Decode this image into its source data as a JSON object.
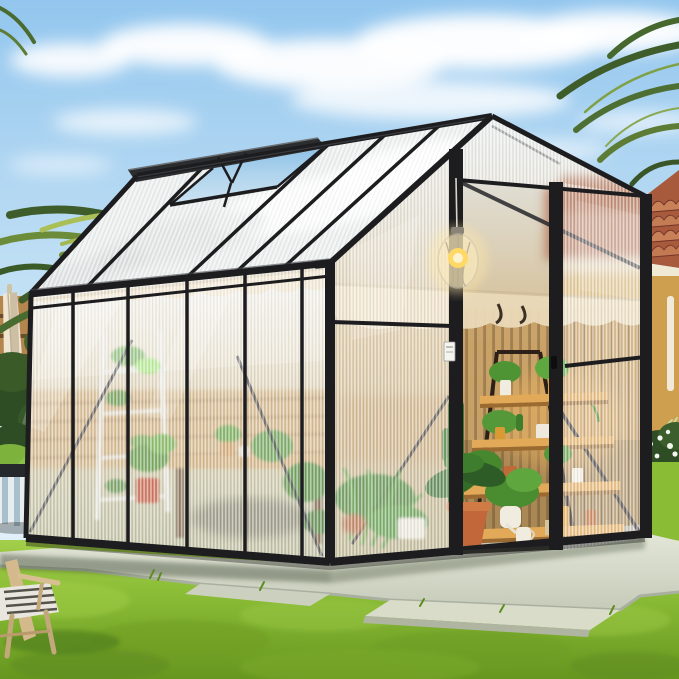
{
  "scene": {
    "description": "Outdoor product photo of a walk-in polycarbonate greenhouse with a black aluminum frame standing on a concrete pad in a sunny backyard lawn, palm trees to the left and a terracotta tile-roof house to the right",
    "objects": [
      {
        "name": "greenhouse",
        "details": "gable-roof greenhouse, black frame, ribbed translucent panels"
      },
      {
        "name": "roof-vent",
        "state": "open, propped up on left roof slope"
      },
      {
        "name": "front-door",
        "state": "open, interior visible"
      },
      {
        "name": "pendant-light",
        "state": "glowing warm, hanging from ridge"
      },
      {
        "name": "plant-shelf",
        "details": "4-tier wooden A-frame ladder shelf with potted plants"
      },
      {
        "name": "interior-plants",
        "details": "potted palm, tall cactus, ferns, bonsai in red pot, pots on wooden bench"
      },
      {
        "name": "shade-cloth",
        "details": "beige scalloped shade fabric hung below the eaves inside"
      },
      {
        "name": "white-tag",
        "details": "small white label sticker on door post"
      },
      {
        "name": "palm-trees",
        "details": "fronds top-left and top-right"
      },
      {
        "name": "house",
        "details": "terracotta barrel-tile roof, cream fascia, yellow stucco wall, white downspout"
      },
      {
        "name": "wood-fence",
        "details": "horizontal plank fence behind greenhouse, left side"
      },
      {
        "name": "patio-umbrella",
        "state": "closed, cream colored, left edge"
      },
      {
        "name": "garden-bushes",
        "details": "dark and bright green shrubs at left"
      },
      {
        "name": "striped-planter-stool",
        "details": "white ceramic stool with blue-grey stripes, dark top"
      },
      {
        "name": "white-flower-bush",
        "details": "right of greenhouse at house base"
      },
      {
        "name": "lawn",
        "details": "vivid green mowed grass"
      },
      {
        "name": "concrete-pad",
        "details": "light concrete foundation pad with step slabs in front of door"
      },
      {
        "name": "wooden-lounge-chair",
        "details": "light wood frame with woven seat, bottom-left corner"
      }
    ]
  },
  "colors": {
    "sky_top": "#93c6ee",
    "sky_mid": "#c0dff4",
    "sky_low": "#d9ecf8",
    "sky_horizon": "#e8f3fa",
    "cloud": "#ffffff",
    "frame": "#1d1d20",
    "frame_hi": "#45484c",
    "grass": "#8abc36",
    "grass_light": "#a3cf4a",
    "grass_dark": "#66961f",
    "pad": "#c6cbb8",
    "pad_light": "#e3e6d8",
    "pad_shadow": "#39452f",
    "tile": "#a85a3c",
    "tile_light": "#c88058",
    "tile_dark": "#6e3226",
    "fascia": "#f0e9d4",
    "house_wall": "#dcae58",
    "pipe_white": "#f4f0e4",
    "fence": "#b5854e",
    "fence_dark": "#6e4c28",
    "umbrella": "#efe6d2",
    "umbrella_shade": "#cdbfa4",
    "shade_cloth": "#ead9b8",
    "wood_shelf": "#e2a958",
    "wood_edge": "#9a6a30",
    "terracotta": "#c06a38",
    "pot_yellow": "#e2a23b",
    "pot_white": "#f0ece0",
    "pot_red": "#bd4a2c",
    "plant_green": "#4e9434",
    "plant_light": "#6fb344",
    "plant_dark": "#2f5c22",
    "lamp_glow": "#ffe9a8",
    "lamp_bulb": "#ffd966",
    "chair_wood": "#d3b98c",
    "seat_weave": "#e9e6df",
    "stool_white": "#e8edf0",
    "stool_stripe": "#a8c0cc",
    "palm_dark": "#3f5c2b",
    "palm_mid": "#6c8c3a",
    "palm_light": "#aabf55",
    "palm_blue": "#7fa390",
    "bush_dark": "#2f4d24",
    "bush_bright": "#7db23c",
    "flower_white": "#f2f4ee",
    "tag_white": "#f4f4f0",
    "floor_grey": "#b7b2a4",
    "slat_light": "#c59a5c",
    "slat_dark": "#8f6a3a"
  }
}
